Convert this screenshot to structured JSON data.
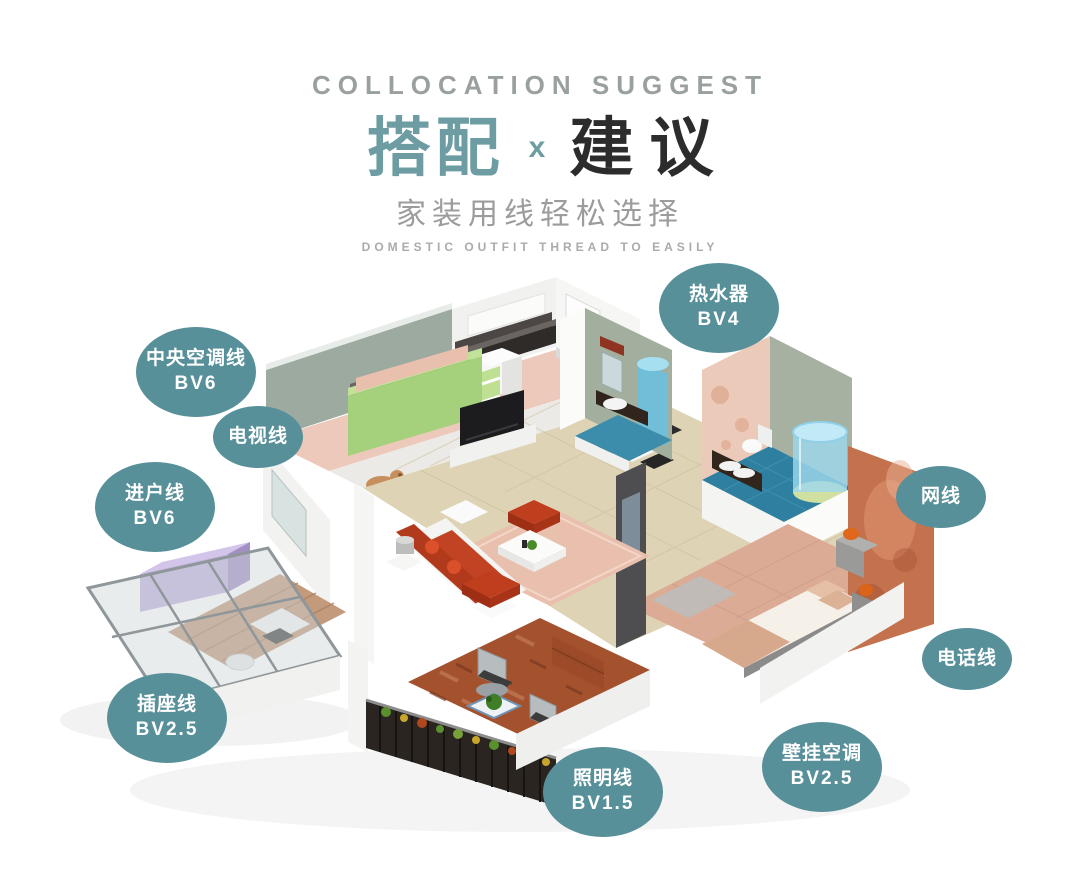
{
  "header": {
    "eyebrow": "COLLOCATION SUGGEST",
    "title_primary": "搭配",
    "title_separator": "x",
    "title_secondary": "建议",
    "subtitle_cn": "家装用线轻松选择",
    "subtitle_en": "DOMESTIC OUTFIT THREAD TO EASILY"
  },
  "colors": {
    "accent_teal": "#6d9da3",
    "badge_teal": "#58909a",
    "title_dark": "#2c2c2c",
    "text_gray": "#9c9c9c",
    "text_light_gray": "#ababab"
  },
  "badges": [
    {
      "id": "water-heater",
      "label": "热水器",
      "spec": "BV4"
    },
    {
      "id": "central-ac",
      "label": "中央空调线",
      "spec": "BV6"
    },
    {
      "id": "tv-line",
      "label": "电视线",
      "spec": ""
    },
    {
      "id": "entry-line",
      "label": "进户线",
      "spec": "BV6"
    },
    {
      "id": "network-line",
      "label": "网线",
      "spec": ""
    },
    {
      "id": "phone-line",
      "label": "电话线",
      "spec": ""
    },
    {
      "id": "socket-line",
      "label": "插座线",
      "spec": "BV2.5"
    },
    {
      "id": "lighting-line",
      "label": "照明线",
      "spec": "BV1.5"
    },
    {
      "id": "wall-ac",
      "label": "壁挂空调",
      "spec": "BV2.5"
    }
  ],
  "illustration": {
    "name": "isometric-apartment-render"
  }
}
